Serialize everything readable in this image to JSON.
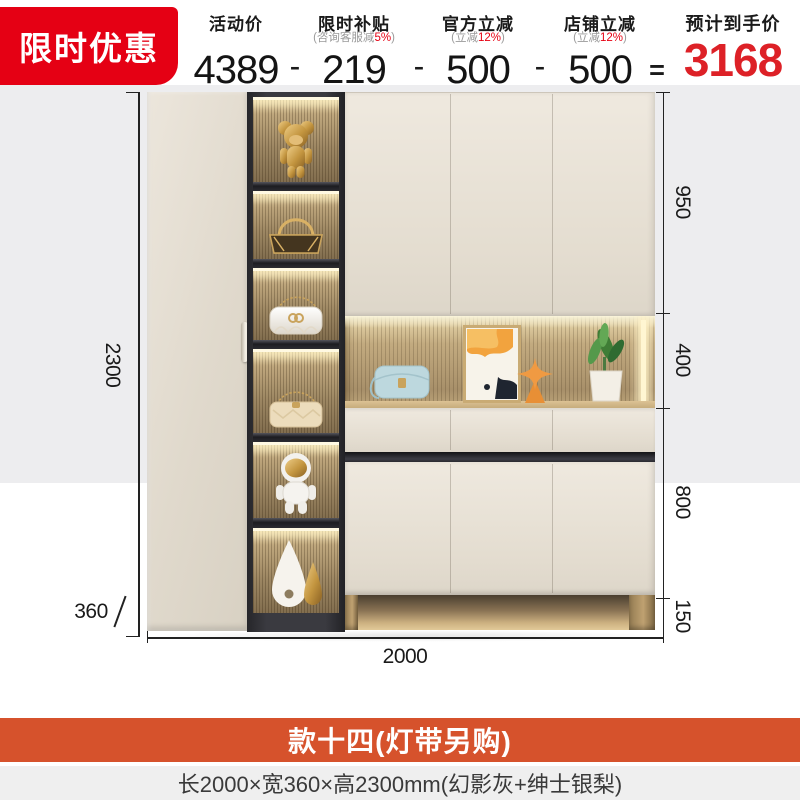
{
  "badge": {
    "text": "限时优惠"
  },
  "pricing": {
    "activity": {
      "label": "活动价",
      "value": "4389"
    },
    "subsidy": {
      "label": "限时补贴",
      "sub_pre": "(咨询客服减",
      "sub_hl": "5%",
      "sub_post": ")",
      "value": "219"
    },
    "official": {
      "label": "官方立减",
      "sub_pre": "(立减",
      "sub_hl": "12%",
      "sub_post": ")",
      "value": "500"
    },
    "store": {
      "label": "店铺立减",
      "sub_pre": "(立减",
      "sub_hl": "12%",
      "sub_post": ")",
      "value": "500"
    },
    "minus": "-",
    "equals": "=",
    "final": {
      "label": "预计到手价",
      "value": "3168"
    }
  },
  "dimensions": {
    "height_mm": "2300",
    "depth_mm": "360",
    "width_mm": "2000",
    "right_segments": [
      "950",
      "400",
      "800",
      "150"
    ]
  },
  "footer": {
    "title": "款十四(灯带另购)",
    "spec": "长2000×宽360×高2300mm(幻影灰+绅士银梨)"
  },
  "decor_items": [
    "gold-bear-figurine",
    "gold-handbag",
    "white-gg-bag",
    "beige-chain-bag",
    "astronaut-figurine",
    "white-and-gold-vases",
    "blue-handbag",
    "abstract-canvas",
    "orange-star-ornament",
    "potted-plant"
  ],
  "colors": {
    "badge_red": "#e50014",
    "price_red": "#dd2127",
    "banner_orange": "#d6522c",
    "panel_gray": "#ededef",
    "cabinet_cream": "#e6dfd3",
    "frame_dark": "#323236"
  }
}
